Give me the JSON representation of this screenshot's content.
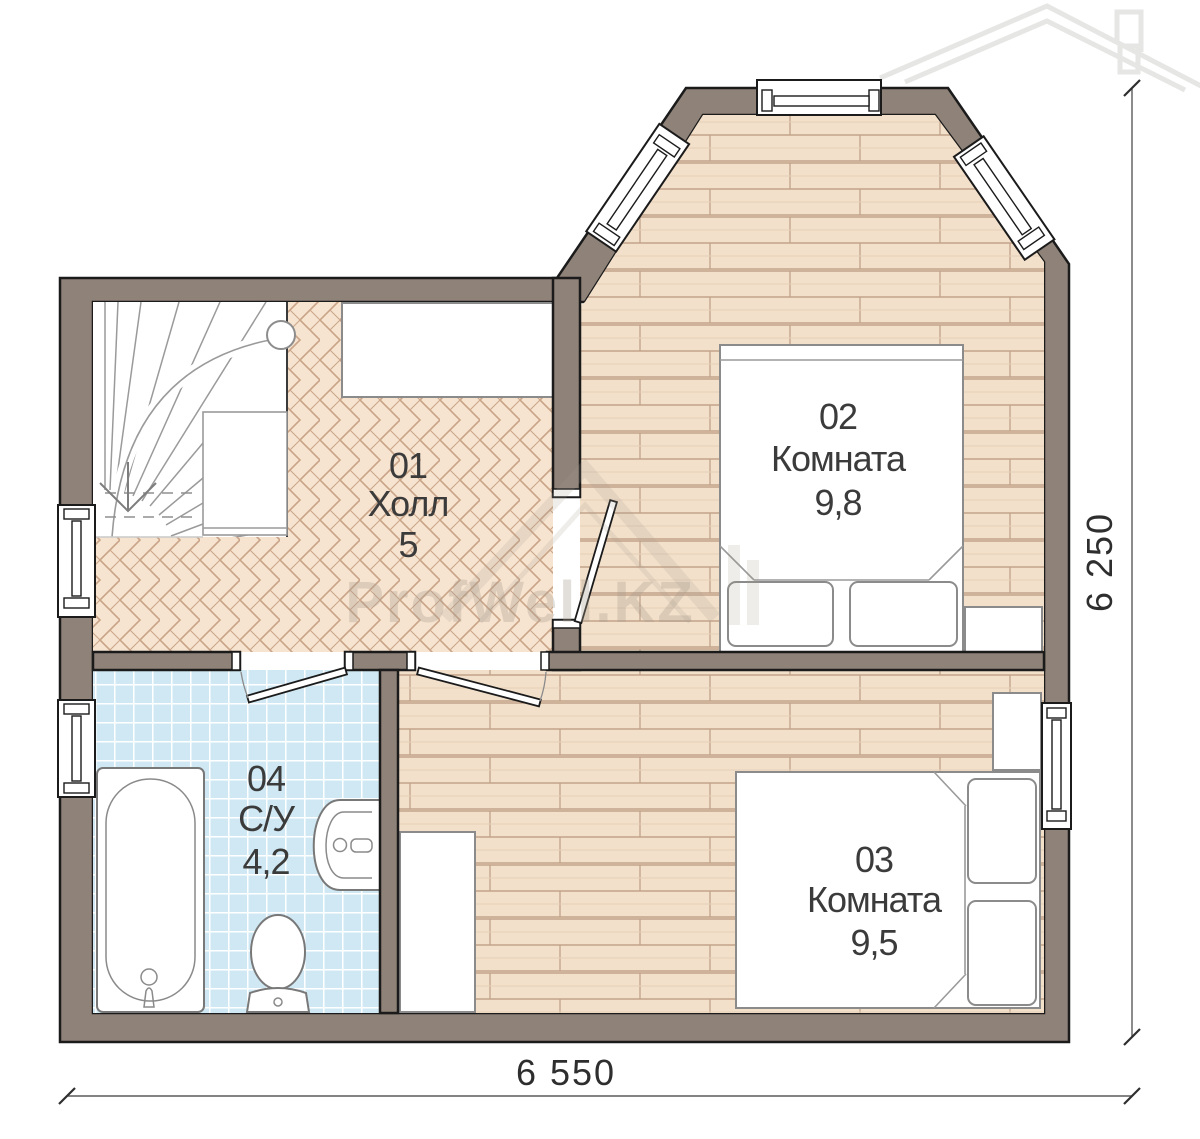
{
  "plan": {
    "title": "Floor plan",
    "rooms": [
      {
        "number": "01",
        "name": "Холл",
        "area": "5"
      },
      {
        "number": "02",
        "name": "Комната",
        "area": "9,8"
      },
      {
        "number": "03",
        "name": "Комната",
        "area": "9,5"
      },
      {
        "number": "04",
        "name": "С/У",
        "area": "4,2"
      }
    ],
    "dimensions": {
      "bottom": "6 550",
      "right": "6 250"
    },
    "watermark": {
      "text": "ProfWell.KZ"
    },
    "colors": {
      "wall": "#8f8379",
      "outline": "#1b1b1b",
      "hall_floor": "#f7e4d0",
      "wood_floor": "#f2e0ca",
      "tile_floor": "#cfe8f3",
      "label_text": "#3b3b3b"
    }
  }
}
